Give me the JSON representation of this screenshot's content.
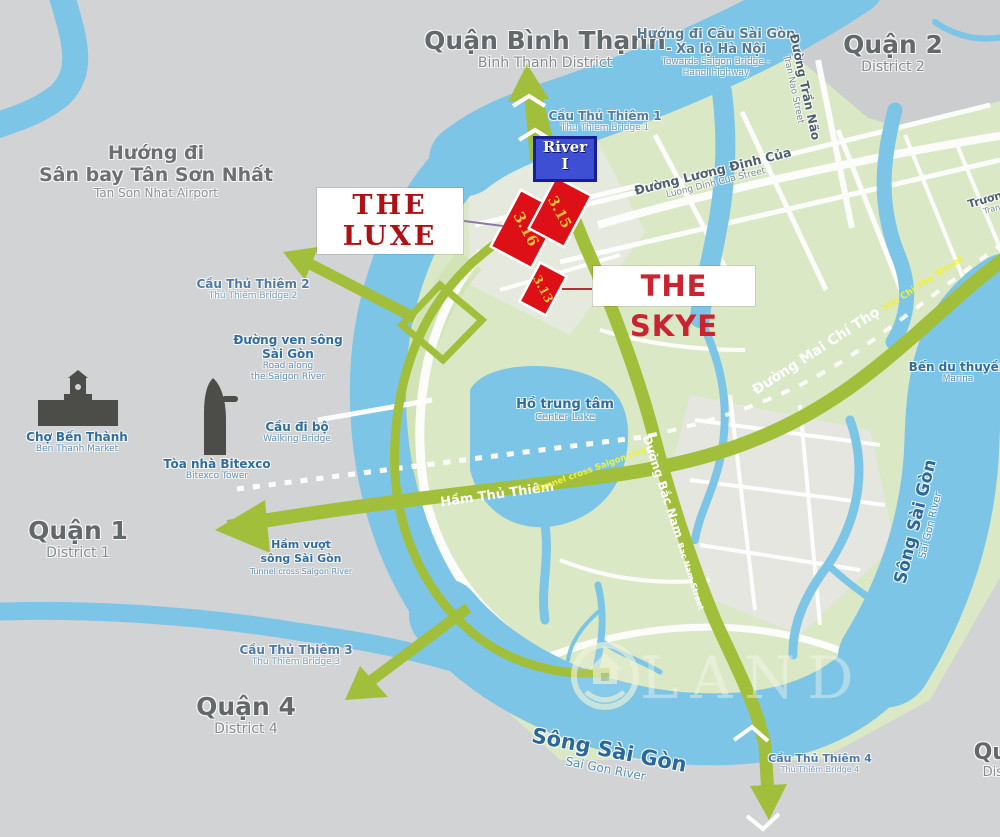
{
  "map": {
    "regions": {
      "binh_thanh": {
        "vi": "Quận Bình Thạnh",
        "en": "Binh Thanh District"
      },
      "district_2": {
        "vi": "Quận 2",
        "en": "District 2"
      },
      "district_1": {
        "vi": "Quận 1",
        "en": "District 1"
      },
      "district_4": {
        "vi": "Quận 4",
        "en": "District 4"
      },
      "district_edge": {
        "vi": "Quận",
        "en": "District"
      }
    },
    "directions": {
      "airport": {
        "vi1": "Hướng đi",
        "vi2": "Sân bay Tân Sơn Nhất",
        "en": "Tan Son Nhat Airport"
      },
      "saigon_bridge": {
        "vi1": "Hướng đi Cầu Sài Gòn",
        "vi2": "- Xa lộ Hà Nội",
        "en1": "Towards Saigon Bridge -",
        "en2": "Hanoi highway"
      }
    },
    "bridges": {
      "tt1": {
        "vi": "Cầu Thủ Thiêm 1",
        "en": "Thu Thiem Bridge 1"
      },
      "tt2": {
        "vi": "Cầu Thủ Thiêm 2",
        "en": "Thủ Thiêm Bridge 2"
      },
      "tt3": {
        "vi": "Cầu Thủ Thiêm 3",
        "en": "Thủ Thiêm Bridge 3"
      },
      "tt4": {
        "vi": "Cầu Thủ Thiêm 4",
        "en": "Thủ Thiêm Bridge 4"
      },
      "walking": {
        "vi": "Cầu đi bộ",
        "en": "Walking Bridge"
      }
    },
    "roads": {
      "mai_chi_tho": {
        "vi": "Đường Mai Chí Thọ",
        "en": "Mai Chi Tho Street"
      },
      "bac_nam": {
        "vi": "Đường Bắc Nam",
        "en": "Bac Nam Street"
      },
      "luong_dinh_cua": {
        "vi": "Đường Lương Định Của",
        "en": "Luong Dinh Cua Street"
      },
      "tran_nao": {
        "vi": "Đường Trần Não",
        "en": "Tran Nao Street"
      },
      "truong_edge": {
        "vi": "Trương",
        "en": "Tran"
      },
      "ven_song": {
        "vi1": "Đường ven sông",
        "vi2": "Sài Gòn",
        "en1": "Road along",
        "en2": "the Saigon River"
      },
      "ham_thu_thiem": {
        "vi": "Hầm Thủ Thiêm",
        "en": "Tunnel cross Saigon river"
      }
    },
    "water": {
      "saigon_river_east": {
        "vi": "Sông Sài Gòn",
        "en": "Sai Gon River"
      },
      "saigon_river_south": {
        "vi": "Sông Sài Gòn",
        "en": "Sai Gon River"
      },
      "center_lake": {
        "vi": "Hồ trung tâm",
        "en": "Center Lake"
      },
      "tunnel": {
        "vi1": "Hầm vượt",
        "vi2": "sông Sài Gòn",
        "en": "Tunnel cross Saigon River"
      },
      "marina": {
        "vi": "Bến du thuyền",
        "en": "Marina"
      }
    },
    "landmarks": {
      "ben_thanh": {
        "vi": "Chợ Bến Thành",
        "en": "Ben Thanh Market"
      },
      "bitexco": {
        "vi": "Tòa nhà Bitexco",
        "en": "Bitexco Tower"
      }
    },
    "projects": {
      "the_luxe": {
        "line1": "THE",
        "line2": "LUXE"
      },
      "the_skye": {
        "label": "THE SKYE"
      },
      "river_block": {
        "line1": "River",
        "line2": "I"
      },
      "parcels": {
        "p315": "3.15",
        "p316": "3.16",
        "p313": "3.13"
      }
    },
    "watermark": {
      "text": "LAND"
    },
    "colors": {
      "water": "#7cc5e7",
      "land_green": "#dbe8c6",
      "road_olive": "#a1bf3b",
      "parcel_red": "#dc1016",
      "luxe_red": "#ae1013",
      "skye_red": "#ca2430",
      "river_box_blue": "#3f4fd4",
      "parcel_gold": "#f2c23c"
    }
  }
}
